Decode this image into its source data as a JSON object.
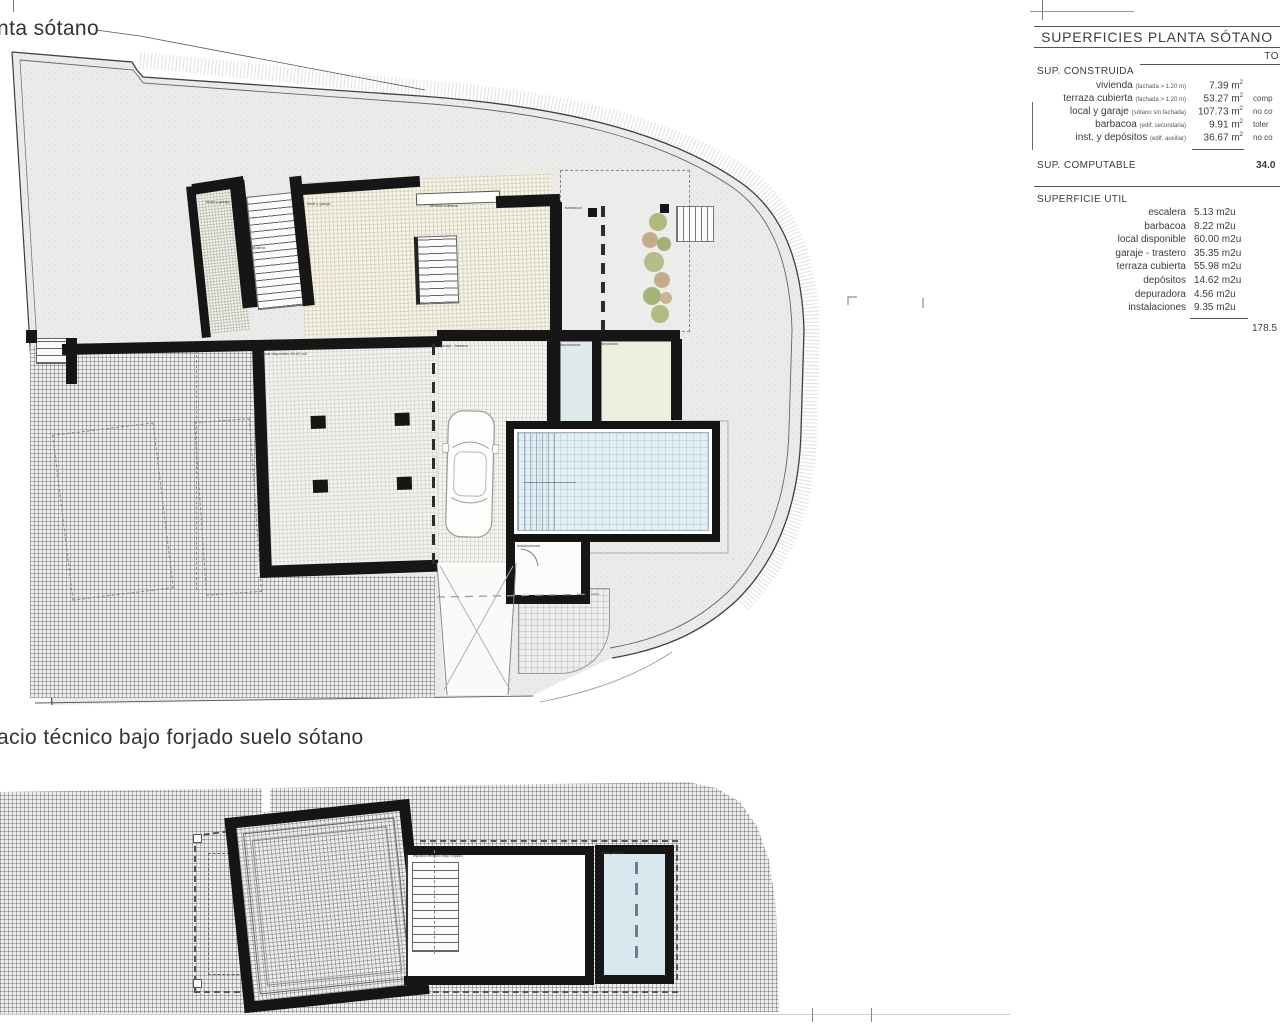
{
  "titles": {
    "top": "nta sótano",
    "bottom": "acio técnico bajo forjado suelo sótano"
  },
  "surfaces_table": {
    "title": "SUPERFICIES PLANTA SÓTANO",
    "total_header": "TO",
    "construida": {
      "label": "SUP. CONSTRUIDA",
      "rows": [
        {
          "name": "vivienda",
          "note": "(fachada > 1.20 m)",
          "value": "7.39",
          "annotation": ""
        },
        {
          "name": "terraza cubierta",
          "note": "(fachada > 1.20 m)",
          "value": "53.27",
          "annotation": "comp"
        },
        {
          "name": "local y garaje",
          "note": "(sótano sin fachada)",
          "value": "107.73",
          "annotation": "no co"
        },
        {
          "name": "barbacoa",
          "note": "(edif. secundaria)",
          "value": "9.91",
          "annotation": "toler"
        },
        {
          "name": "inst. y depósitos",
          "note": "(edif. auxiliar)",
          "value": "36.67",
          "annotation": "no co"
        }
      ]
    },
    "computable": {
      "label": "SUP. COMPUTABLE",
      "value": "34.0"
    },
    "util": {
      "label": "SUPERFICIE UTIL",
      "rows": [
        {
          "name": "escalera",
          "value": "5.13 m2u"
        },
        {
          "name": "barbacoa",
          "value": "8.22 m2u"
        },
        {
          "name": "local disponible",
          "value": "60.00 m2u"
        },
        {
          "name": "garaje - trastero",
          "value": "35.35 m2u"
        },
        {
          "name": "terraza cubierta",
          "value": "55.98 m2u"
        },
        {
          "name": "depósitos",
          "value": "14.62 m2u"
        },
        {
          "name": "depuradora",
          "value": "4.56 m2u"
        },
        {
          "name": "instalaciones",
          "value": "9.35 m2u"
        }
      ],
      "total": "178.5"
    }
  },
  "plan_labels": [
    {
      "text": "local y garaje",
      "x": 206,
      "y": 200
    },
    {
      "text": "escalera",
      "x": 250,
      "y": 246
    },
    {
      "text": "local y garaje",
      "x": 307,
      "y": 202
    },
    {
      "text": "terraza cubierta",
      "x": 430,
      "y": 204
    },
    {
      "text": "barbacoa",
      "x": 565,
      "y": 206
    },
    {
      "text": "local disponible 60.00 m2",
      "x": 262,
      "y": 352
    },
    {
      "text": "garaje - trastero",
      "x": 440,
      "y": 344
    },
    {
      "text": "depuradora",
      "x": 560,
      "y": 343
    },
    {
      "text": "depósitos",
      "x": 601,
      "y": 342
    },
    {
      "text": "instalaciones",
      "x": 517,
      "y": 544
    },
    {
      "text": "espacio técnico bajo forjado",
      "x": 413,
      "y": 854
    },
    {
      "text": "vaso piscina",
      "x": 601,
      "y": 851
    }
  ],
  "colors": {
    "wall": "#161616",
    "pool_water": "#e3eef2",
    "terrain": "#ebebe9",
    "room_blue": "#dfeaec",
    "room_green": "#eef0de",
    "plant_green": "#9fae66",
    "plant_brown": "#b99e72"
  }
}
